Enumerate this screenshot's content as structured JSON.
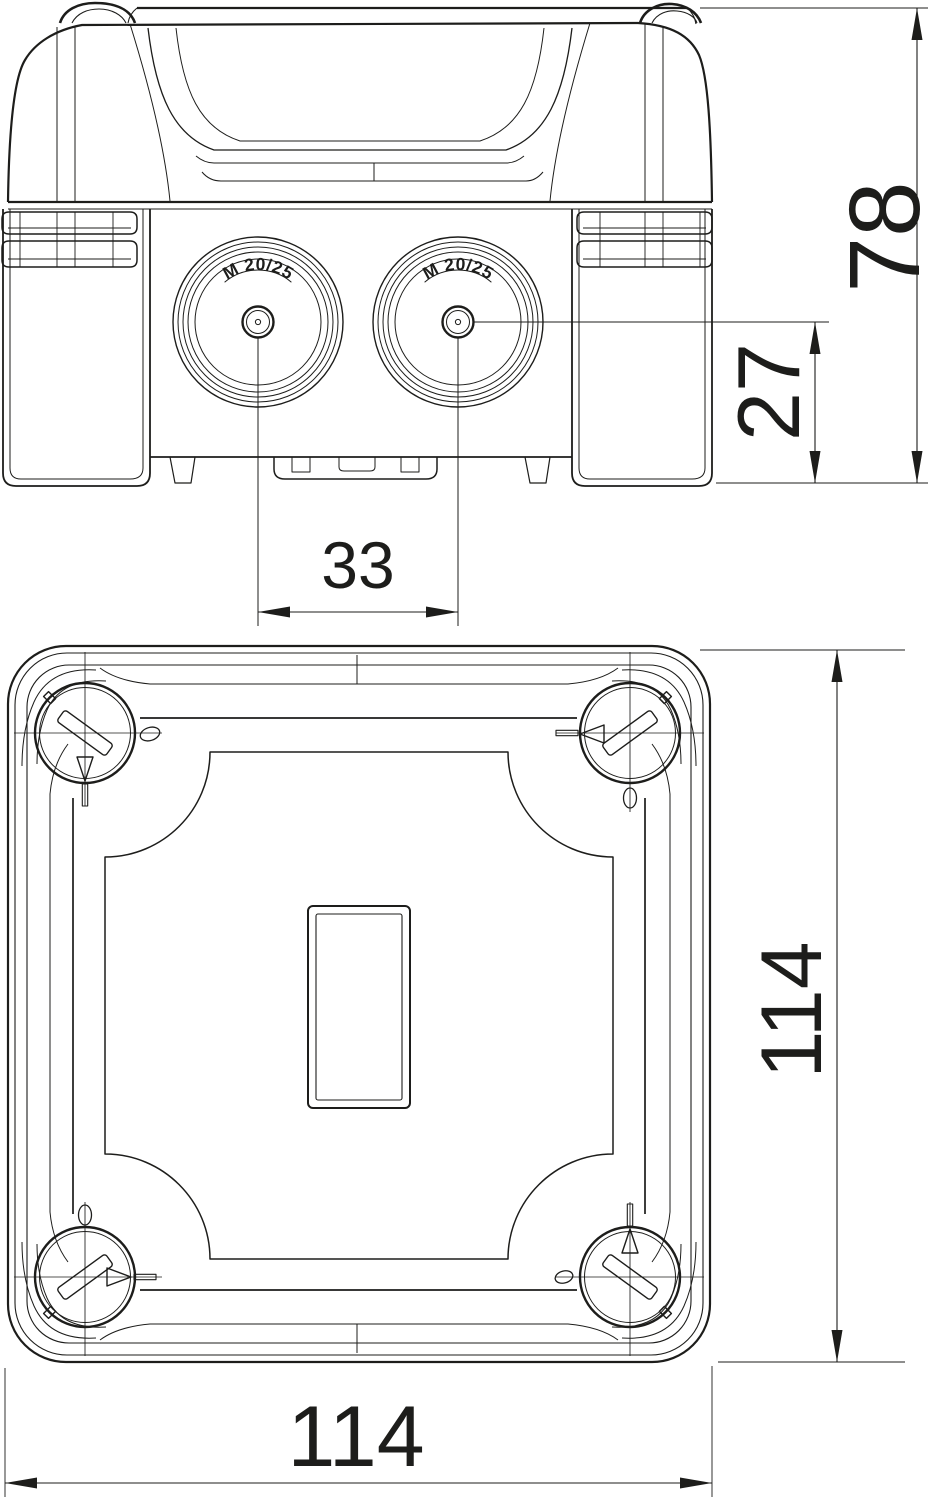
{
  "drawing": {
    "background": "#ffffff",
    "line_color": "#1d1d1b",
    "side_view": {
      "gland_left_label": "M 20/25",
      "gland_right_label": "M 20/25",
      "dim_overall_height": "78",
      "dim_entry_center_height": "27",
      "dim_entry_spacing": "33"
    },
    "plan_view": {
      "dim_depth": "114",
      "dim_width": "114"
    }
  }
}
